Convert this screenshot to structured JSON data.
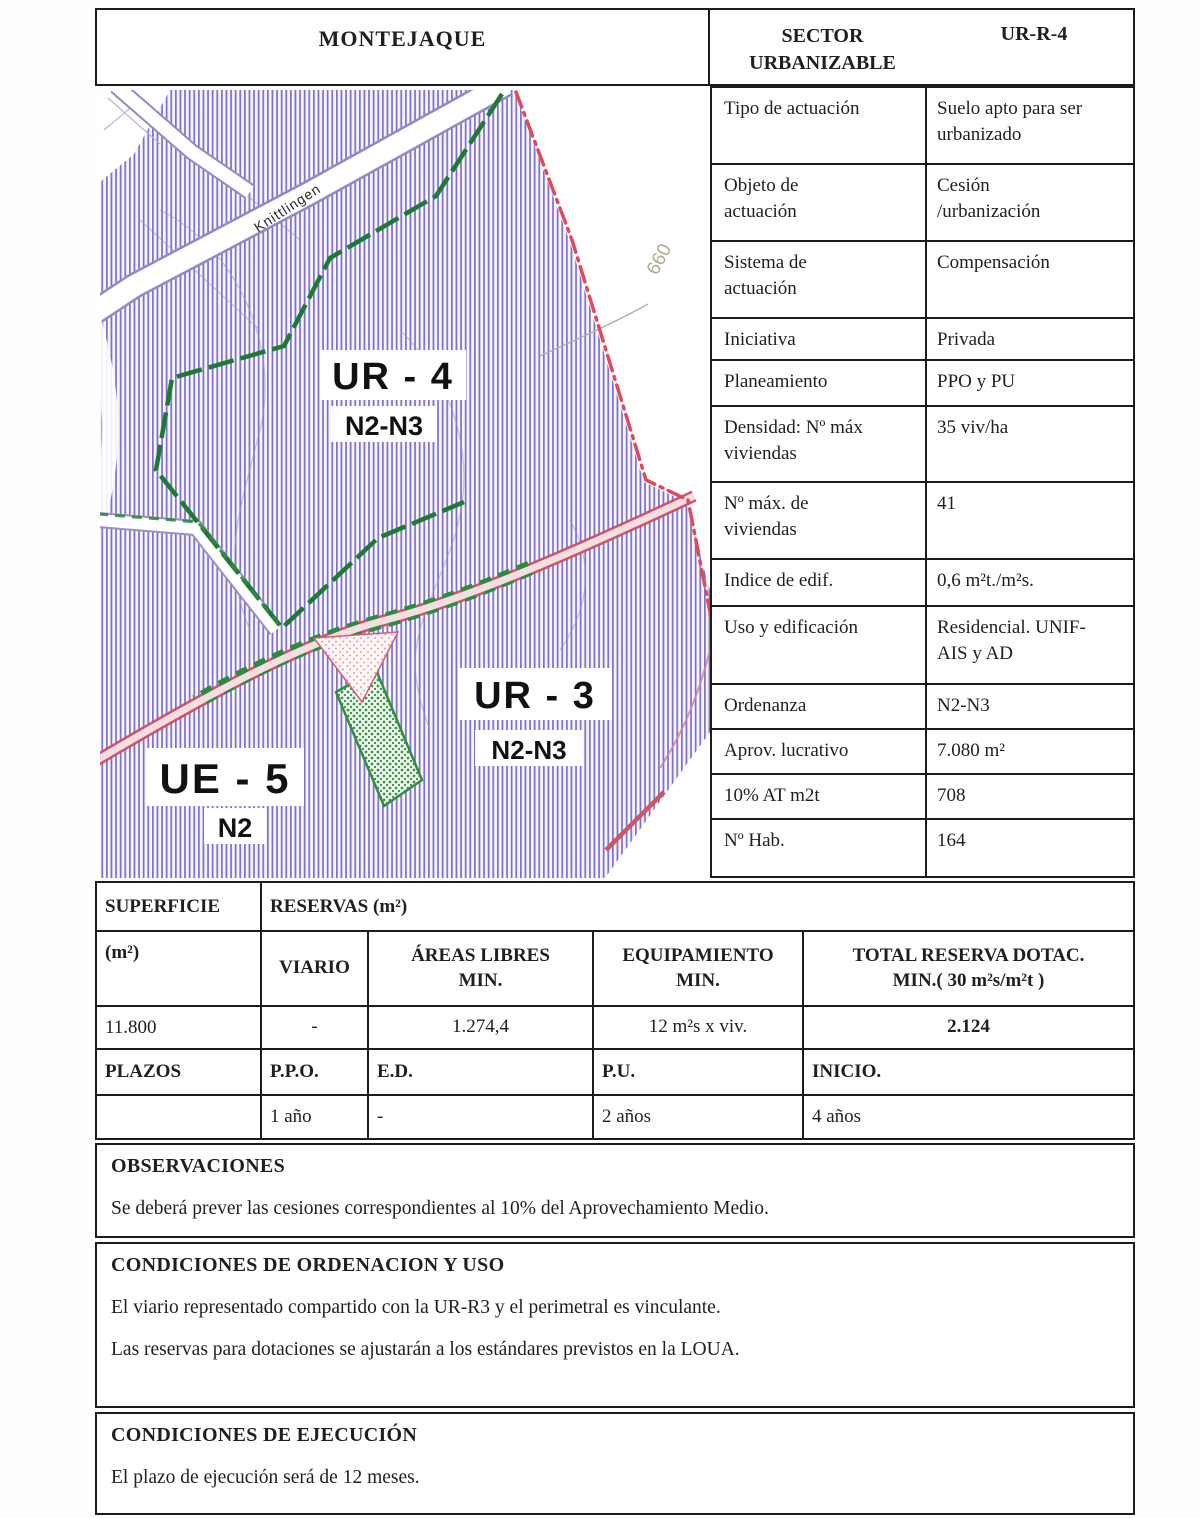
{
  "header": {
    "municipality": "MONTEJAQUE",
    "sector_label": "SECTOR\nURBANIZABLE",
    "sector_code": "UR-R-4"
  },
  "attributes": {
    "rows": [
      {
        "label": "Tipo de actuación",
        "value": "Suelo apto para ser\nurbanizado"
      },
      {
        "label": "Objeto de\nactuación",
        "value": "Cesión\n/urbanización"
      },
      {
        "label": "Sistema de\nactuación",
        "value": "Compensación"
      },
      {
        "label": "Iniciativa",
        "value": "Privada"
      },
      {
        "label": "Planeamiento",
        "value": "PPO y PU"
      },
      {
        "label": "Densidad: Nº máx\nviviendas",
        "value": "35 viv/ha"
      },
      {
        "label": "Nº máx. de\nviviendas",
        "value": "41"
      },
      {
        "label": "Indice de edif.",
        "value": "0,6 m²t./m²s."
      },
      {
        "label": "Uso y edificación",
        "value": "Residencial. UNIF-\nAIS y AD"
      },
      {
        "label": "Ordenanza",
        "value": "N2-N3"
      },
      {
        "label": "Aprov.  lucrativo",
        "value": "7.080 m²"
      },
      {
        "label": "10% AT m2t",
        "value": "708"
      },
      {
        "label": "Nº Hab.",
        "value": "164"
      }
    ]
  },
  "reservas": {
    "title_col1": "SUPERFICIE",
    "title_col2": "RESERVAS (m²)",
    "headers": [
      "(m²)",
      "VIARIO",
      "ÁREAS LIBRES\nMIN.",
      "EQUIPAMIENTO\nMIN.",
      "TOTAL RESERVA DOTAC.\nMIN.( 30 m²s/m²t )"
    ],
    "values": [
      "11.800",
      "-",
      "1.274,4",
      "12 m²s x viv.",
      "2.124"
    ]
  },
  "plazos": {
    "headers": [
      "PLAZOS",
      "P.P.O.",
      "E.D.",
      "P.U.",
      "INICIO."
    ],
    "values": [
      "",
      "1 año",
      "-",
      "2 años",
      "4 años"
    ]
  },
  "sections": {
    "observaciones": {
      "heading": "OBSERVACIONES",
      "p1": "Se deberá prever las cesiones correspondientes al 10% del Aprovechamiento Medio."
    },
    "ordenacion": {
      "heading": "CONDICIONES DE ORDENACION Y USO",
      "p1": "El viario representado compartido con la UR-R3 y el perimetral es vinculante.",
      "p2": "Las reservas para dotaciones se ajustarán a los estándares previstos en la LOUA."
    },
    "ejecucion": {
      "heading": "CONDICIONES DE EJECUCIÓN",
      "p1": "El plazo de ejecución será de 12 meses."
    }
  },
  "map": {
    "region_labels": [
      {
        "name": "UR - 4",
        "sub": "N2-N3"
      },
      {
        "name": "UR - 3",
        "sub": "N2-N3"
      },
      {
        "name": "UE - 5",
        "sub": "N2"
      }
    ],
    "street_label": "Knittlingen",
    "contour_label": "660",
    "colors": {
      "hatch_stripe": "#7e6fc5",
      "boundary_green": "#1e7a32",
      "limit_red": "#e04a5a",
      "road_pink_edge": "#cc4e5e",
      "parcel_green": "#2f8f3f"
    }
  }
}
